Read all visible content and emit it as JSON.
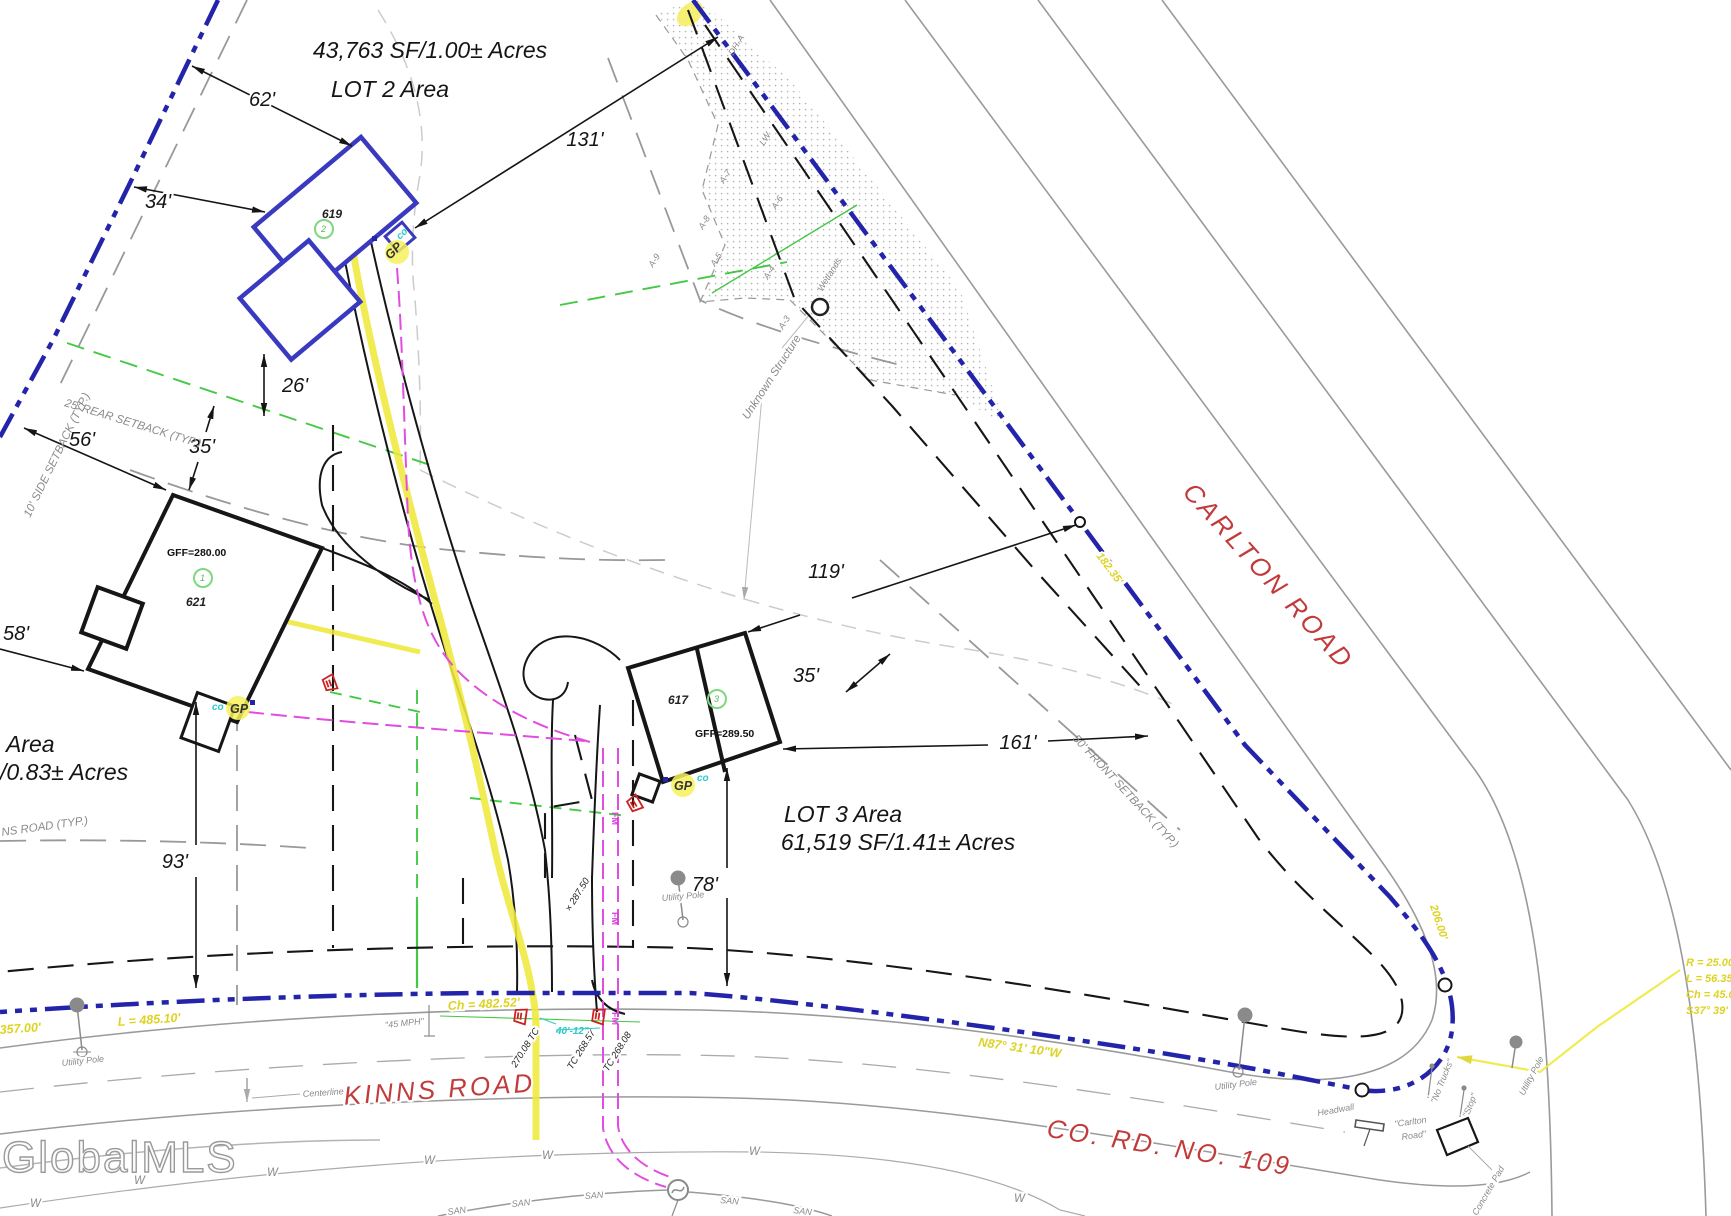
{
  "lots": {
    "lot1": {
      "name": "Area",
      "area": "/0.83± Acres"
    },
    "lot2": {
      "name": "LOT 2 Area",
      "area": "43,763 SF/1.00± Acres"
    },
    "lot3": {
      "name": "LOT 3 Area",
      "area": "61,519 SF/1.41± Acres"
    }
  },
  "buildings": {
    "b619": {
      "num": "619",
      "circle": "2"
    },
    "b621": {
      "num": "621",
      "circle": "1",
      "gff": "GFF=280.00"
    },
    "b617": {
      "num": "617",
      "circle": "3",
      "gff": "GFF=289.50"
    }
  },
  "dims": {
    "d62": "62'",
    "d131": "131'",
    "d34": "34'",
    "d26": "26'",
    "d35l": "35'",
    "d56": "56'",
    "d58": "58'",
    "d93": "93'",
    "d119": "119'",
    "d35r": "35'",
    "d161": "161'",
    "d78": "78'"
  },
  "setbacks": {
    "rear": "25' REAR SETBACK (TYP.)",
    "side": "10' SIDE SETBACK (TYP.)",
    "front": "50' FRONT SETBACK (TYP.)",
    "kinns_partial": "NS ROAD (TYP.)"
  },
  "roads": {
    "carlton": "CARLTON ROAD",
    "kinns": "KINNS ROAD",
    "co_rd": "CO. RD. NO. 109",
    "centerline": "Centerline",
    "speed": "\"45 MPH\""
  },
  "survey": {
    "l_485": "L = 485.10'",
    "ch_482": "Ch = 482.52'",
    "d357": "357.00'",
    "bearing": "N87° 31' 10\"W",
    "dist_1": "182.35'",
    "dist_2": "206.00'",
    "curve": [
      "R = 25.00'",
      "L = 56.35'",
      "Ch = 45.00'",
      "S37° 39' E"
    ]
  },
  "utilities": {
    "gp": "GP",
    "co": "co",
    "utility_pole": "Utility Pole",
    "culvert": "40'-12\"",
    "tc1": "270.08 TC",
    "tc2": "TC 268.57",
    "tc3": "TC 268.08",
    "spot": "× 287.50",
    "w": "W",
    "san": "SAN",
    "fm": "FM"
  },
  "features": {
    "headwall": "Headwall",
    "sign_carlton_1": "\"Carlton",
    "sign_carlton_2": "Road\"",
    "sign_no_trucks": "\"No Trucks\"",
    "sign_stop": "\"Stop\"",
    "concrete_pad": "Concrete Pad",
    "unknown_structure": "Unknown Structure",
    "wetlands": "Wetlands",
    "wetland_flags": [
      "DH-A",
      "LW",
      "A-7",
      "A-6",
      "A-8",
      "A-9",
      "A-5",
      "A-4",
      "A-3"
    ]
  },
  "watermark": "GlobalMLS",
  "colors": {
    "boundary_blue": "#2424aa",
    "building_blue": "#3a3ac0",
    "gas_yellow": "#f0e93c",
    "force_main_magenta": "#e14ce1",
    "buffer_green": "#44c944",
    "road_red": "#c23b3b",
    "culvert_red": "#cc2222",
    "cleanout_cyan": "#2fc9c9"
  }
}
